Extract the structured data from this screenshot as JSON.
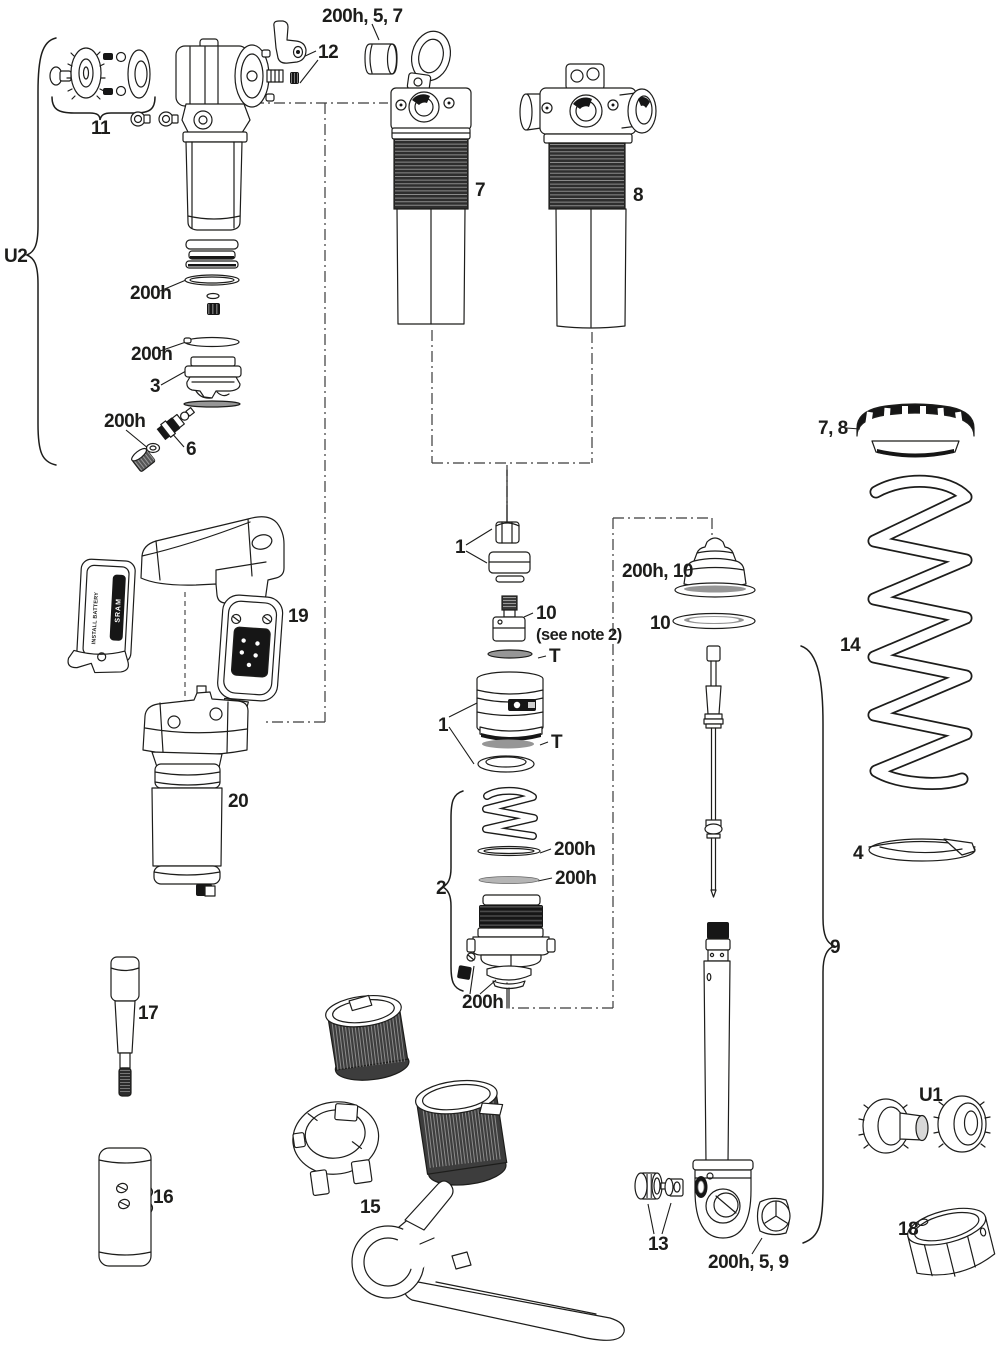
{
  "diagram": {
    "subject": "Rear shock exploded service parts diagram",
    "background": "#ffffff",
    "line_color": "#1d1d1b"
  },
  "labels": {
    "top_bushing_group": "200h, 5, 7",
    "lever_pin": "12",
    "mount_hardware_left": "11",
    "u2_group": "U2",
    "shock_7": "7",
    "shock_8": "8",
    "oring_a": "200h",
    "oring_b": "200h",
    "air_valve": "3",
    "oring_c": "200h",
    "valve_core": "6",
    "module": "19",
    "air_can": "20",
    "shaft_hw_upper": "1",
    "adjuster_10": "10",
    "see_note": "(see note 2)",
    "t_upper": "T",
    "bumper_group": "200h, 10",
    "bumper_ring": "10",
    "piston_1": "1",
    "t_lower": "T",
    "ifp_group": "2",
    "oring_d": "200h",
    "oring_e": "200h",
    "oring_f": "200h",
    "preload_collar": "7, 8",
    "coil_spring": "14",
    "spring_retainer": "4",
    "damper_group": "9",
    "socket_tool": "17",
    "sleeve_tool": "16",
    "tool_set": "15",
    "eyelet_hw": "13",
    "eyelet_bushing_group": "200h, 5, 9",
    "u1_group": "U1",
    "cup_18": "18",
    "battery_install": "INSTALL BATTERY",
    "battery_brand": "SRAM"
  }
}
